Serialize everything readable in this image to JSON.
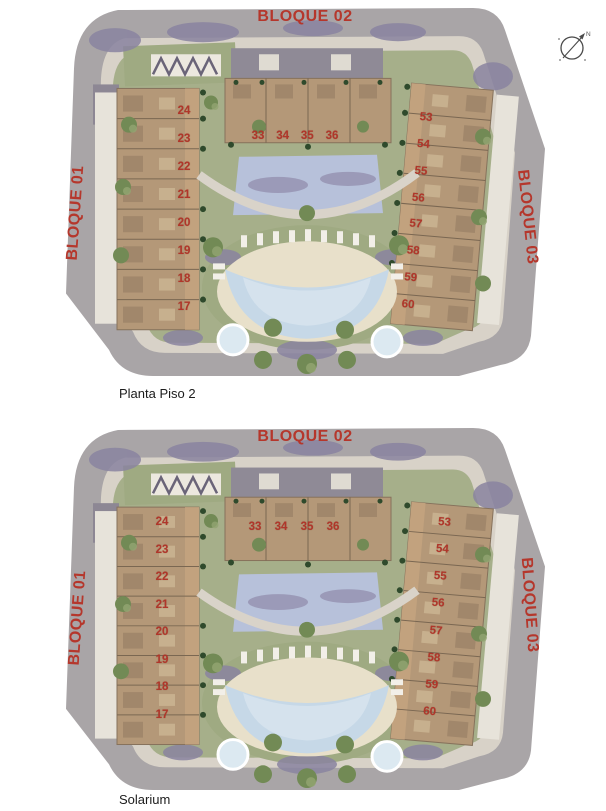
{
  "compass": {
    "north_label": "N"
  },
  "plans": [
    {
      "caption": "Planta Piso 2",
      "blocks": {
        "top": {
          "label": "BLOQUE 02",
          "units": [
            "33",
            "34",
            "35",
            "36"
          ]
        },
        "left": {
          "label": "BLOQUE 01",
          "units": [
            "24",
            "23",
            "22",
            "21",
            "20",
            "19",
            "18",
            "17"
          ]
        },
        "right": {
          "label": "BLOQUE 03",
          "units": [
            "53",
            "54",
            "55",
            "56",
            "57",
            "58",
            "59",
            "60"
          ]
        }
      }
    },
    {
      "caption": "Solarium",
      "blocks": {
        "top": {
          "label": "BLOQUE 02",
          "units": [
            "33",
            "34",
            "35",
            "36"
          ]
        },
        "left": {
          "label": "BLOQUE 01",
          "units": [
            "24",
            "23",
            "22",
            "21",
            "20",
            "19",
            "18",
            "17"
          ]
        },
        "right": {
          "label": "BLOQUE 03",
          "units": [
            "53",
            "54",
            "55",
            "56",
            "57",
            "58",
            "59",
            "60"
          ]
        }
      }
    }
  ],
  "colors": {
    "label-red": "#b5372c",
    "number-red": "#b0362a",
    "caption-color": "#1c1c1c",
    "road-gray": "#a9a5a7",
    "pavement-beige": "#d8d2c8",
    "lawn-green": "#a6af8a",
    "roof-tan": "#b49878",
    "terrace-tan": "#c2a27e",
    "white-roof": "#e7e3da",
    "pool-blue": "#c6d8e7",
    "sand-beige": "#e8e0ca",
    "shadow-purple": "#8a84a0"
  }
}
